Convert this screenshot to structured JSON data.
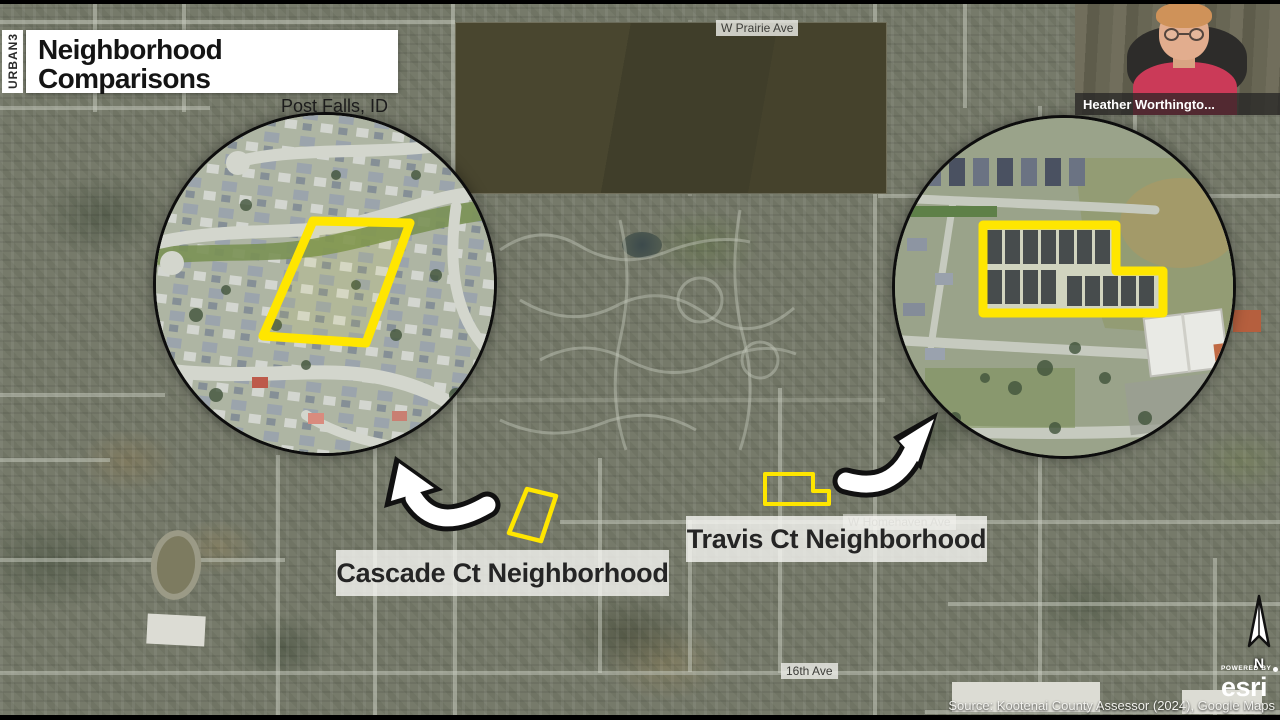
{
  "slide": {
    "brand_vertical": "URBAN3",
    "title": "Neighborhood Comparisons",
    "subtitle": "Post Falls, ID",
    "source_credit": "Source: Kootenai County Assessor (2024), Google Maps"
  },
  "webcam": {
    "participant_name": "Heather Worthingto..."
  },
  "map": {
    "streets": {
      "prairie": "W Prairie Ave",
      "homehaven": "W Homehaven Ave",
      "sixteenth": "16th Ave"
    },
    "neighborhoods": {
      "cascade": "Cascade Ct Neighborhood",
      "travis": "Travis Ct Neighborhood"
    }
  },
  "compass": {
    "north_label": "N"
  },
  "esri_logo": {
    "powered_by": "POWERED BY",
    "brand": "esri"
  },
  "colors": {
    "highlight_yellow": "#FFE600",
    "label_bar_bg": "rgba(246,246,243,0.80)",
    "title_text": "#141414"
  }
}
